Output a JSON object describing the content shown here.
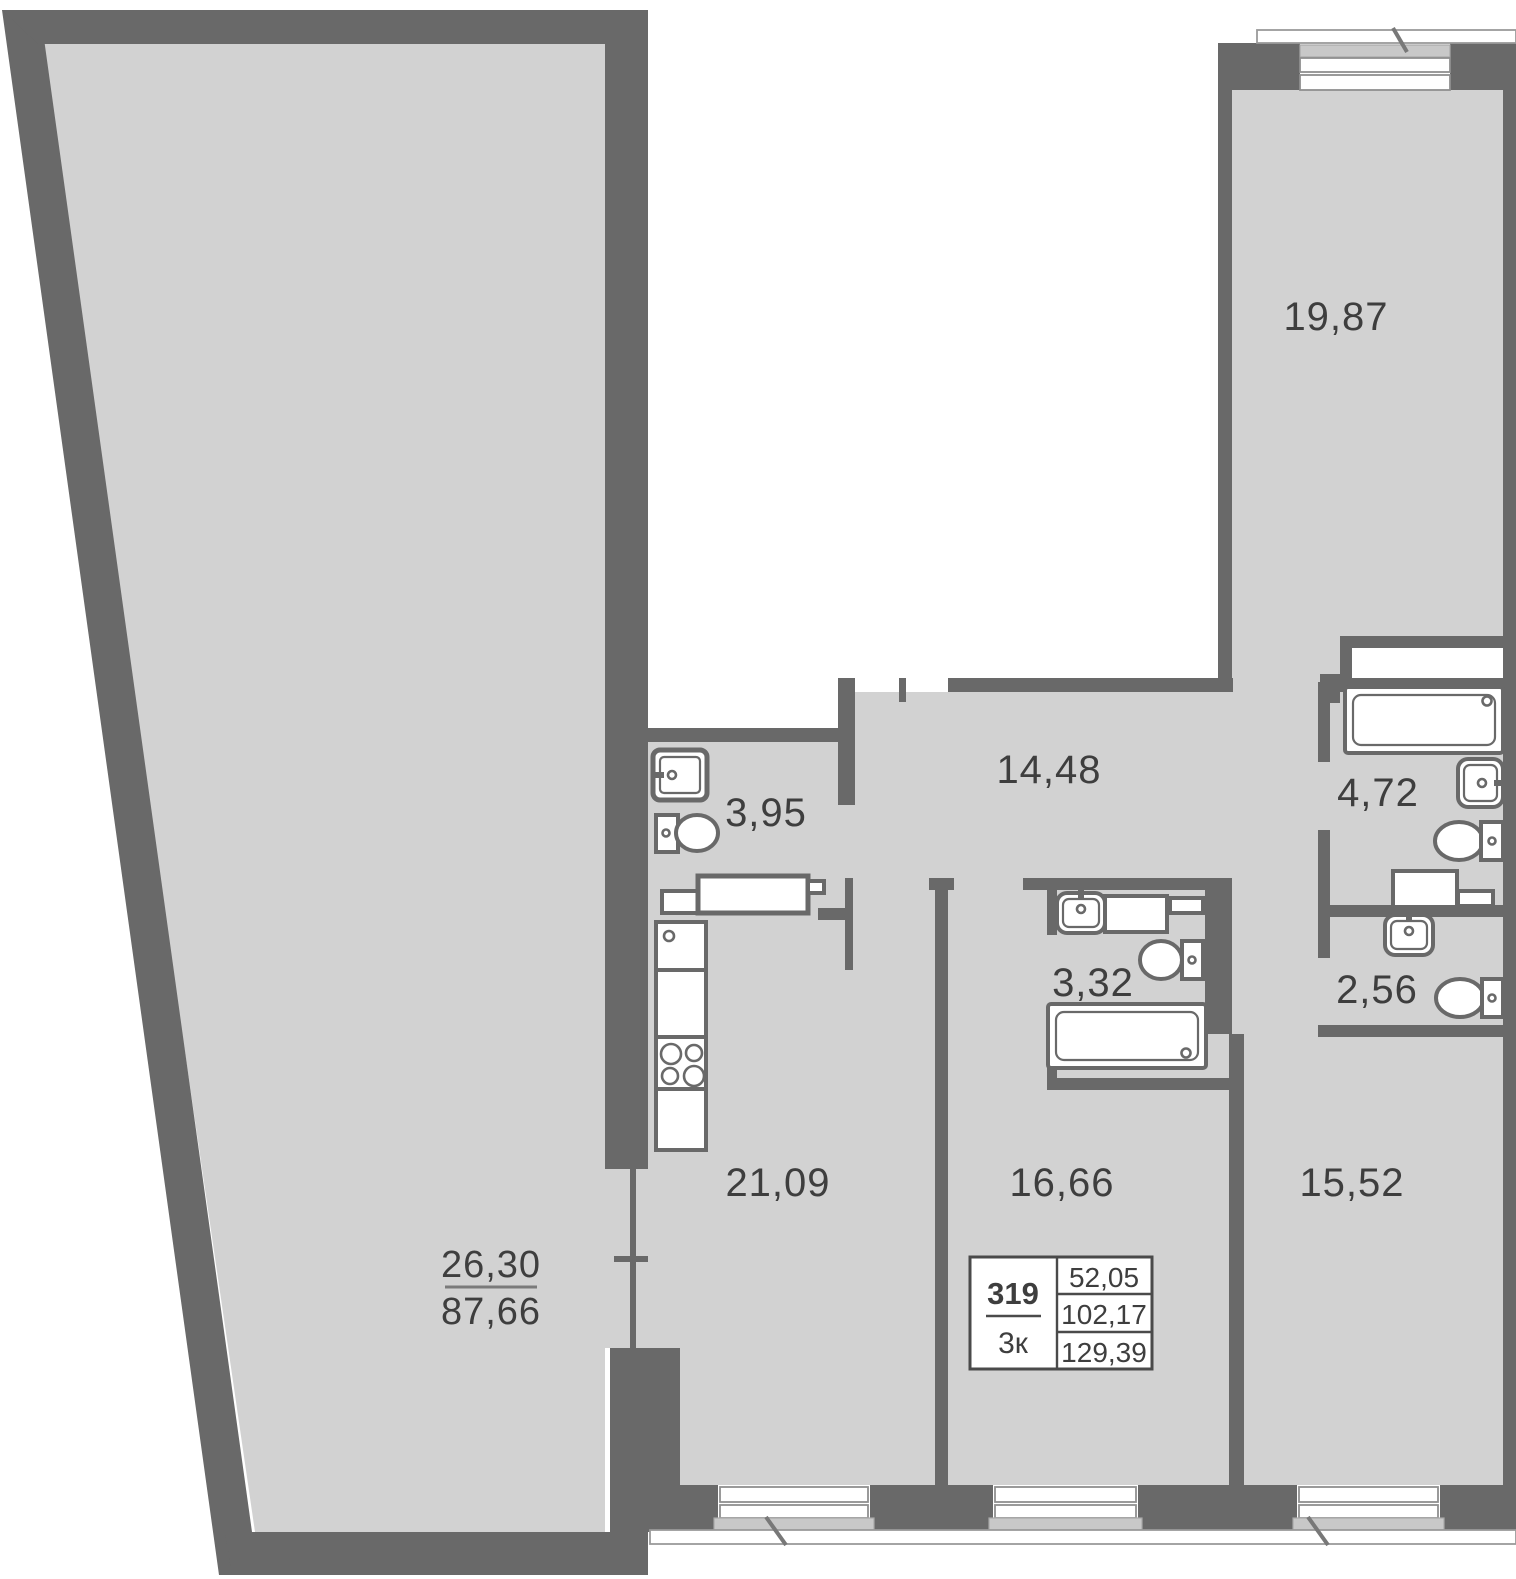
{
  "plan": {
    "title": "apartment-floor-plan",
    "rooms": [
      {
        "id": "terrace",
        "area": "26,30",
        "area_total": "87,66"
      },
      {
        "id": "bedroom-top",
        "area": "19,87"
      },
      {
        "id": "hallway",
        "area": "14,48"
      },
      {
        "id": "wc-small",
        "area": "3,95"
      },
      {
        "id": "bathroom-main",
        "area": "4,72"
      },
      {
        "id": "bathroom-second",
        "area": "3,32"
      },
      {
        "id": "wc-guest",
        "area": "2,56"
      },
      {
        "id": "kitchen-living",
        "area": "21,09"
      },
      {
        "id": "bedroom-middle",
        "area": "16,66"
      },
      {
        "id": "bedroom-right",
        "area": "15,52"
      }
    ],
    "info_box": {
      "unit_number": "319",
      "unit_type": "3к",
      "area_living": "52,05",
      "area_total": "102,17",
      "area_with_summer": "129,39"
    },
    "colors": {
      "wall": "#696969",
      "floor": "#d2d2d2",
      "window_sill": "#c8c8c8",
      "text": "#3e3e3e",
      "background": "#ffffff"
    }
  }
}
